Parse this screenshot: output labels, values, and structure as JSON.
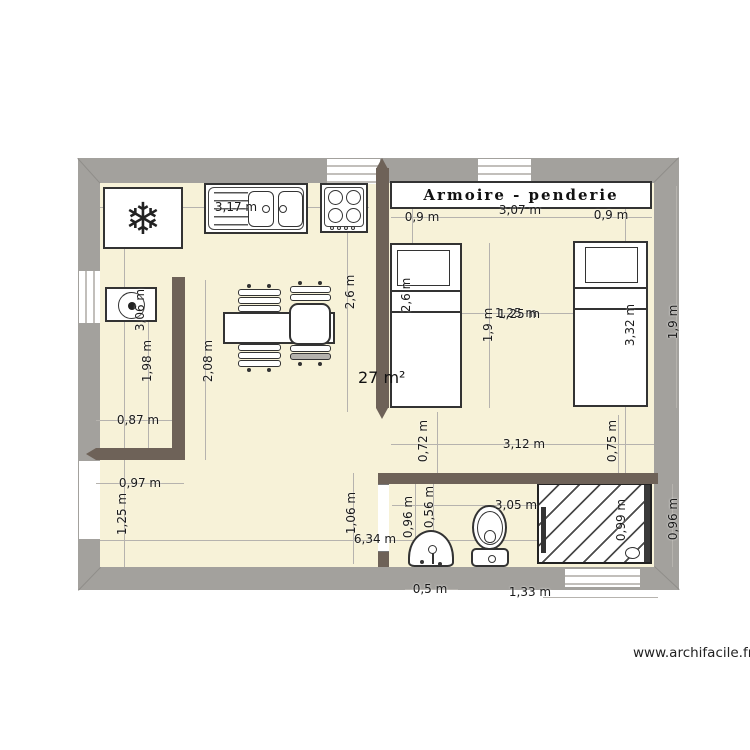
{
  "page": {
    "watermark": "www.archifacile.fr"
  },
  "plan": {
    "room_area_label": "27 m²",
    "wardrobe_label": "Armoire - penderie",
    "furniture_items": [
      "fridge",
      "sink-unit",
      "stove",
      "washing-machine",
      "dining-table",
      "armchair",
      "chairs",
      "wardrobe",
      "bed",
      "bed",
      "washbasin",
      "toilet",
      "shower"
    ],
    "dimension_labels": [
      {
        "text": "3,17 m",
        "x": 236,
        "y": 207,
        "v": false
      },
      {
        "text": "0,9 m",
        "x": 422,
        "y": 217,
        "v": false
      },
      {
        "text": "3,07 m",
        "x": 520,
        "y": 210,
        "v": false
      },
      {
        "text": "0,9 m",
        "x": 611,
        "y": 215,
        "v": false
      },
      {
        "text": "1,25 m",
        "x": 516,
        "y": 313,
        "v": false
      },
      {
        "text": "1,25 m",
        "x": 519,
        "y": 314,
        "v": false
      },
      {
        "text": "0,87 m",
        "x": 138,
        "y": 420,
        "v": false
      },
      {
        "text": "0,97 m",
        "x": 140,
        "y": 483,
        "v": false
      },
      {
        "text": "3,12 m",
        "x": 524,
        "y": 444,
        "v": false
      },
      {
        "text": "3,05 m",
        "x": 516,
        "y": 505,
        "v": false
      },
      {
        "text": "6,34 m",
        "x": 375,
        "y": 539,
        "v": false
      },
      {
        "text": "0,5 m",
        "x": 430,
        "y": 589,
        "v": false
      },
      {
        "text": "1,33 m",
        "x": 530,
        "y": 592,
        "v": false
      },
      {
        "text": "3,06 m",
        "x": 140,
        "y": 310,
        "v": true
      },
      {
        "text": "1,98 m",
        "x": 147,
        "y": 361,
        "v": true
      },
      {
        "text": "2,08 m",
        "x": 208,
        "y": 361,
        "v": true
      },
      {
        "text": "2,6 m",
        "x": 350,
        "y": 292,
        "v": true
      },
      {
        "text": "2,6 m",
        "x": 406,
        "y": 295,
        "v": true
      },
      {
        "text": "1,9 m",
        "x": 488,
        "y": 325,
        "v": true
      },
      {
        "text": "3,32 m",
        "x": 630,
        "y": 325,
        "v": true
      },
      {
        "text": "1,9 m",
        "x": 673,
        "y": 322,
        "v": true
      },
      {
        "text": "0,72 m",
        "x": 423,
        "y": 441,
        "v": true
      },
      {
        "text": "0,75 m",
        "x": 612,
        "y": 441,
        "v": true
      },
      {
        "text": "1,06 m",
        "x": 351,
        "y": 513,
        "v": true
      },
      {
        "text": "1,25 m",
        "x": 122,
        "y": 514,
        "v": true
      },
      {
        "text": "0,96 m",
        "x": 408,
        "y": 517,
        "v": true
      },
      {
        "text": "0,56 m",
        "x": 429,
        "y": 507,
        "v": true
      },
      {
        "text": "0,99 m",
        "x": 621,
        "y": 520,
        "v": true
      },
      {
        "text": "0,96 m",
        "x": 673,
        "y": 519,
        "v": true
      }
    ]
  },
  "colors": {
    "floor": "#f7f2d8",
    "wall": "#a3a19d",
    "partition": "#6e6258",
    "dim_line": "#b6b3ae",
    "outline": "#2e2e2e"
  }
}
